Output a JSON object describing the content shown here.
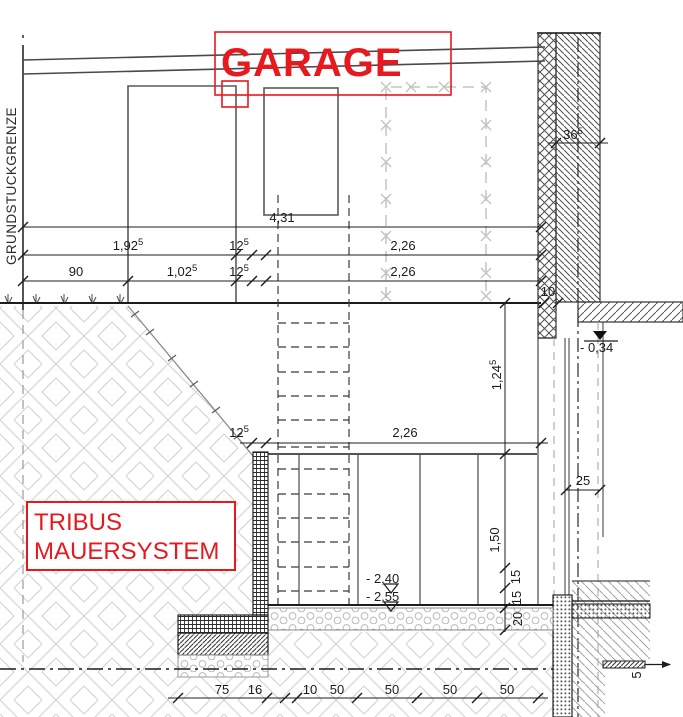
{
  "drawing_type": "building-section",
  "labels": {
    "room": "GARAGE",
    "wall_system_line1": "TRIBUS",
    "wall_system_line2": "MAUERSYSTEM",
    "property_boundary": "GRUNDSTUCKGRENZE"
  },
  "colors": {
    "annotation_red": "#e8181f",
    "line_dark": "#1c1c1c",
    "hatch_gray": "#cfcfcf"
  },
  "dimensions": {
    "horizontal_total": {
      "base": "4,31",
      "sup": ""
    },
    "garage_left_total": {
      "base": "1,92",
      "sup": "5"
    },
    "pier_upper": {
      "base": "12",
      "sup": "5"
    },
    "bay_right_upper": {
      "base": "2,26",
      "sup": ""
    },
    "left_offset": {
      "base": "90",
      "sup": ""
    },
    "door_width": {
      "base": "1,02",
      "sup": "5"
    },
    "pier_lower": {
      "base": "12",
      "sup": "5"
    },
    "bay_right_lower": {
      "base": "2,26",
      "sup": ""
    },
    "wall_thickness": {
      "base": "36",
      "sup": "5"
    },
    "wall_base_gap": {
      "base": "10",
      "sup": ""
    },
    "stair_wall": {
      "base": "12",
      "sup": "5"
    },
    "stair_run": {
      "base": "2,26",
      "sup": ""
    },
    "storey_upper": {
      "base": "1,24",
      "sup": "5"
    },
    "storey_lower": {
      "base": "1,50",
      "sup": ""
    },
    "ledge": {
      "base": "25",
      "sup": ""
    },
    "layer_top": {
      "base": "15",
      "sup": ""
    },
    "layer_mid": {
      "base": "15",
      "sup": ""
    },
    "layer_bottom": {
      "base": "20",
      "sup": ""
    },
    "footing_width": {
      "base": "75",
      "sup": ""
    },
    "footing_edge": {
      "base": "16",
      "sup": ""
    },
    "floor_gap": {
      "base": "10",
      "sup": ""
    },
    "grid_1": {
      "base": "50",
      "sup": ""
    },
    "grid_2": {
      "base": "50",
      "sup": ""
    },
    "grid_3": {
      "base": "50",
      "sup": ""
    },
    "grid_4": {
      "base": "50",
      "sup": ""
    },
    "step_height": {
      "base": "5",
      "sup": ""
    }
  },
  "levels": {
    "ground_floor": "- 0,34",
    "basement_top": "- 2,40",
    "basement_bottom": "- 2,55"
  }
}
